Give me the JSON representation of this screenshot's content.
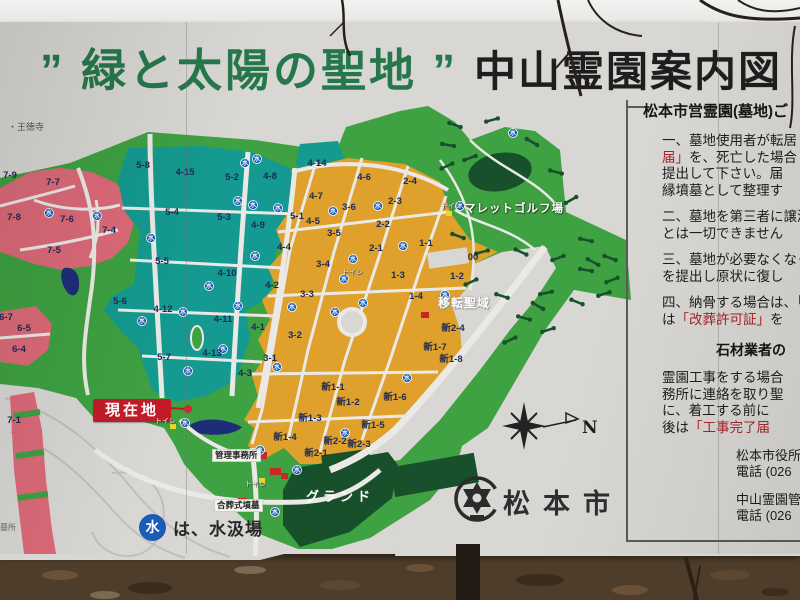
{
  "sign": {
    "title": {
      "green_text": "” 緑と太陽の聖地 ”",
      "black_text": "中山霊園案内図"
    }
  },
  "map": {
    "colors": {
      "green": "#3ea142",
      "teal": "#149a90",
      "pink": "#dc6a79",
      "orange": "#dfa02c",
      "dark_green": "#17502b",
      "road": "#eae9e5",
      "pond": "#1c2e78",
      "water_blue": "#1a5cb8",
      "current_red": "#c21b28"
    },
    "zones": [
      [
        "5-8",
        143,
        168
      ],
      [
        "4-15",
        185,
        175
      ],
      [
        "5-2",
        232,
        180
      ],
      [
        "4-8",
        270,
        179
      ],
      [
        "4-14",
        317,
        166
      ],
      [
        "5-4",
        172,
        215
      ],
      [
        "5-3",
        224,
        220
      ],
      [
        "4-9",
        258,
        228
      ],
      [
        "5-5",
        162,
        264
      ],
      [
        "4-10",
        227,
        276
      ],
      [
        "4-12",
        163,
        312
      ],
      [
        "4-11",
        223,
        322
      ],
      [
        "5-6",
        120,
        304
      ],
      [
        "5-7",
        164,
        360
      ],
      [
        "4-13",
        212,
        356
      ],
      [
        "7-9",
        10,
        178
      ],
      [
        "7-7",
        53,
        185
      ],
      [
        "7-8",
        14,
        220
      ],
      [
        "7-6",
        67,
        222
      ],
      [
        "7-4",
        109,
        233
      ],
      [
        "7-5",
        54,
        253
      ],
      [
        "6-7",
        6,
        320
      ],
      [
        "6-5",
        24,
        331
      ],
      [
        "6-4",
        19,
        352
      ],
      [
        "7-1",
        14,
        423
      ],
      [
        "4-6",
        364,
        180
      ],
      [
        "2-4",
        410,
        184
      ],
      [
        "4-7",
        316,
        199
      ],
      [
        "2-3",
        395,
        204
      ],
      [
        "3-6",
        349,
        210
      ],
      [
        "5-1",
        297,
        219
      ],
      [
        "4-5",
        313,
        224
      ],
      [
        "2-2",
        383,
        227
      ],
      [
        "3-5",
        334,
        236
      ],
      [
        "1-1",
        426,
        246
      ],
      [
        "4-4",
        284,
        250
      ],
      [
        "2-1",
        376,
        251
      ],
      [
        "00",
        473,
        260
      ],
      [
        "3-4",
        323,
        267
      ],
      [
        "1-3",
        398,
        278
      ],
      [
        "1-2",
        457,
        279
      ],
      [
        "4-2",
        272,
        288
      ],
      [
        "3-3",
        307,
        297
      ],
      [
        "1-4",
        416,
        299
      ],
      [
        "4-1",
        258,
        330
      ],
      [
        "3-2",
        295,
        338
      ],
      [
        "新2-4",
        453,
        331
      ],
      [
        "新1-7",
        435,
        350
      ],
      [
        "3-1",
        270,
        361
      ],
      [
        "新1-8",
        451,
        362
      ],
      [
        "4-3",
        245,
        376
      ],
      [
        "新1-1",
        333,
        390
      ],
      [
        "新1-6",
        395,
        400
      ],
      [
        "新1-2",
        348,
        405
      ],
      [
        "新1-3",
        310,
        421
      ],
      [
        "新1-5",
        373,
        428
      ],
      [
        "新1-4",
        285,
        440
      ],
      [
        "新2-2",
        335,
        444
      ],
      [
        "新2-3",
        359,
        447
      ],
      [
        "新2-1",
        316,
        456
      ]
    ],
    "water_points": [
      [
        49,
        213
      ],
      [
        97,
        216
      ],
      [
        245,
        163
      ],
      [
        257,
        159
      ],
      [
        238,
        201
      ],
      [
        253,
        205
      ],
      [
        278,
        208
      ],
      [
        151,
        238
      ],
      [
        255,
        256
      ],
      [
        209,
        286
      ],
      [
        238,
        306
      ],
      [
        183,
        312
      ],
      [
        142,
        321
      ],
      [
        223,
        349
      ],
      [
        188,
        371
      ],
      [
        292,
        307
      ],
      [
        277,
        367
      ],
      [
        333,
        211
      ],
      [
        378,
        206
      ],
      [
        403,
        246
      ],
      [
        353,
        259
      ],
      [
        344,
        279
      ],
      [
        363,
        303
      ],
      [
        445,
        295
      ],
      [
        513,
        133
      ],
      [
        460,
        206
      ],
      [
        335,
        312
      ],
      [
        407,
        378
      ],
      [
        345,
        433
      ],
      [
        185,
        423
      ],
      [
        260,
        450
      ],
      [
        297,
        470
      ],
      [
        275,
        512
      ]
    ],
    "golf_holes": [
      [
        455,
        125,
        20
      ],
      [
        492,
        120,
        -15
      ],
      [
        532,
        142,
        30
      ],
      [
        447,
        166,
        -25
      ],
      [
        556,
        172,
        15
      ],
      [
        571,
        200,
        -30
      ],
      [
        458,
        236,
        20
      ],
      [
        482,
        252,
        -15
      ],
      [
        521,
        252,
        25
      ],
      [
        558,
        258,
        -20
      ],
      [
        586,
        270,
        10
      ],
      [
        471,
        282,
        -25
      ],
      [
        502,
        296,
        18
      ],
      [
        546,
        293,
        -12
      ],
      [
        577,
        302,
        22
      ],
      [
        604,
        294,
        -18
      ],
      [
        593,
        262,
        28
      ],
      [
        612,
        280,
        -22
      ],
      [
        524,
        318,
        15
      ],
      [
        548,
        330,
        -18
      ],
      [
        538,
        306,
        30
      ],
      [
        510,
        340,
        -25
      ],
      [
        586,
        240,
        12
      ],
      [
        610,
        258,
        20
      ],
      [
        448,
        145,
        10
      ],
      [
        470,
        158,
        -20
      ]
    ],
    "labels": {
      "current_location": "現在地",
      "mallet_golf": "マレットゴルフ場",
      "relocation": "移転聖域",
      "admin_office": "管理事務所",
      "communal_grave": "合葬式墳墓",
      "ground": "グランド",
      "toilet": "トイレ",
      "temple": "・王徳寺",
      "corner_note": "墓所",
      "legend_symbol": "水",
      "legend_text": "は、水汲場"
    }
  },
  "compass": {
    "label": "N"
  },
  "city": {
    "name": "松本市"
  },
  "panel": {
    "header": "松本市営霊園(墓地)ご",
    "lines": [
      {
        "b1": "一、墓地使用者が転居し"
      },
      {
        "r": "届」",
        "b2": "を、死亡した場合"
      },
      {
        "b1": "提出して下さい。届"
      },
      {
        "b1": "縁墳墓として整理す"
      },
      {
        "b1": "二、墓地を第三者に譲渡"
      },
      {
        "b1": "とは一切できません"
      },
      {
        "b1": "三、墓地が必要なくなっ"
      },
      {
        "b1": "を提出し原状に復し"
      },
      {
        "b1": "四、納骨する場合は、",
        "r": "「"
      },
      {
        "b1": "は",
        "r": "「改葬許可証」",
        "b2": "を"
      }
    ],
    "subheader": "石材業者の",
    "lines2": [
      {
        "b1": "霊園工事をする場合"
      },
      {
        "b1": "務所に連絡を取り聖"
      },
      {
        "b1": "に、着工する前に"
      },
      {
        "b1": "後は",
        "r": "「工事完了届"
      }
    ],
    "contacts": [
      {
        "name": "松本市役所",
        "tel": "電話 (026"
      },
      {
        "name": "中山霊園管",
        "tel": "電話 (026"
      }
    ]
  }
}
